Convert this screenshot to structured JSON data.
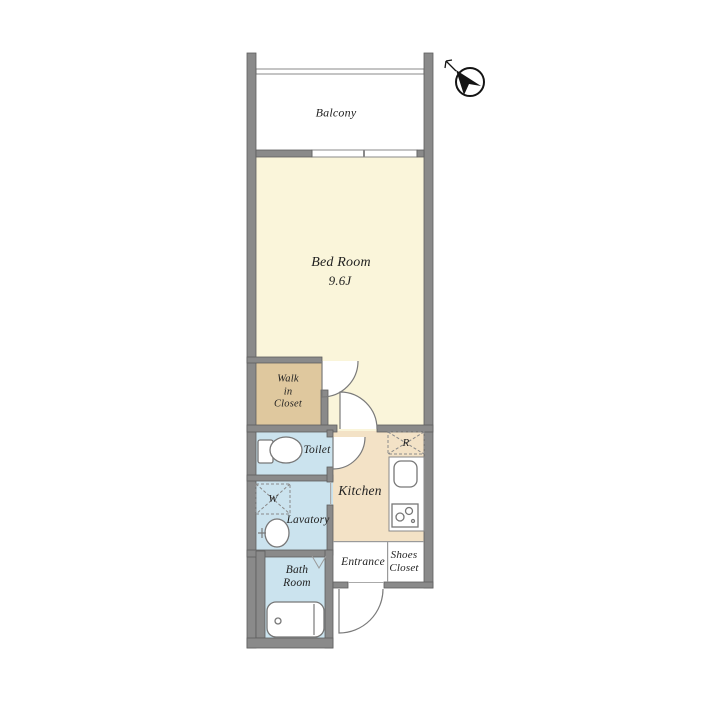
{
  "colors": {
    "wall": "#8a8a8a",
    "bedroom": "#faf5da",
    "closet": "#dfc89e",
    "wet_rooms": "#cbe3ee",
    "kitchen": "#f3e2c6",
    "white": "#ffffff",
    "thin_line": "#9a9a9a",
    "text": "#1f1f1f",
    "compass": "#141414"
  },
  "rooms": {
    "balcony": {
      "label": "Balcony"
    },
    "bed_room": {
      "label": "Bed Room",
      "size": "9.6J"
    },
    "walk_in_closet": {
      "line1": "Walk",
      "line2": "in",
      "line3": "Closet"
    },
    "toilet": {
      "label": "Toilet"
    },
    "lavatory": {
      "label": "Lavatory"
    },
    "bath_room": {
      "line1": "Bath",
      "line2": "Room"
    },
    "kitchen": {
      "label": "Kitchen"
    },
    "entrance": {
      "label": "Entrance"
    },
    "shoes_closet": {
      "line1": "Shoes",
      "line2": "Closet"
    }
  },
  "appliances": {
    "refrigerator": "R",
    "washing_machine": "W"
  }
}
